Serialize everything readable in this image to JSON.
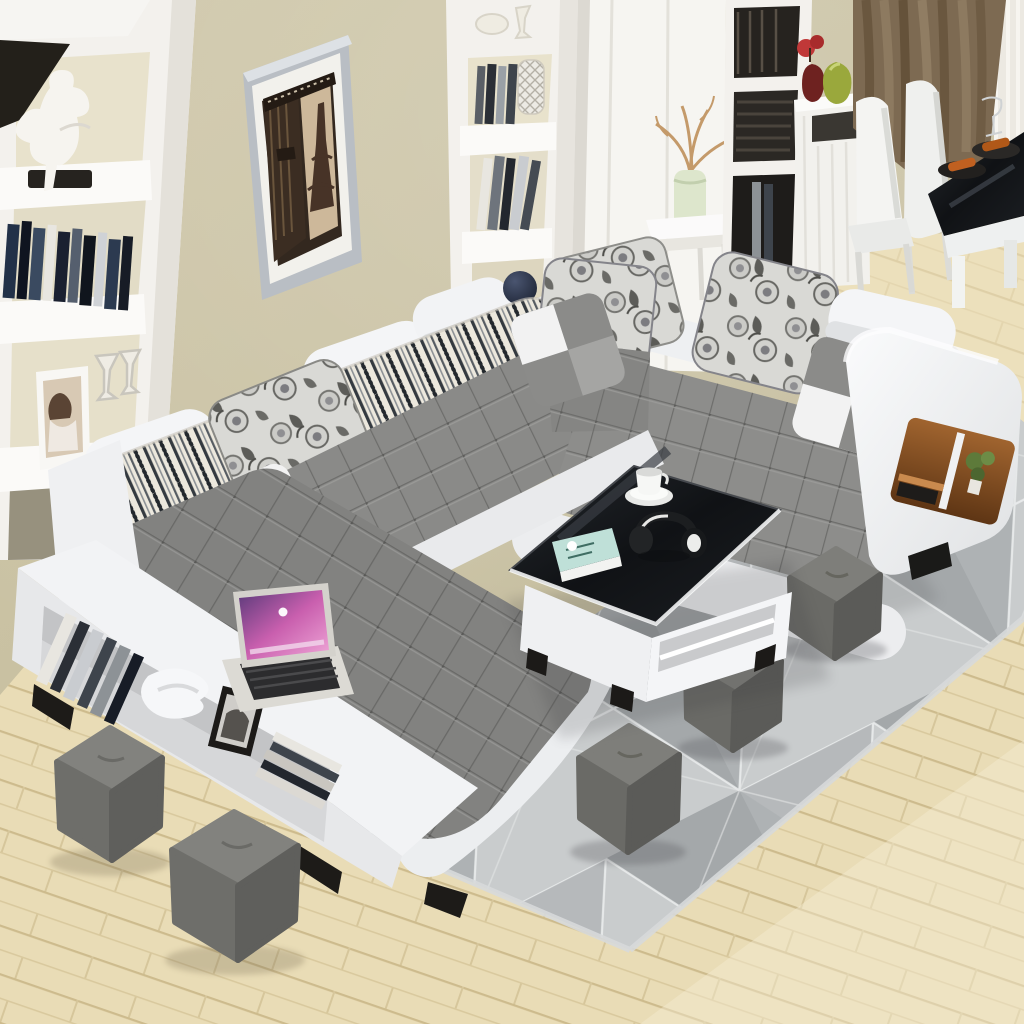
{
  "scene": {
    "type": "living-room-photograph",
    "description": "Modern living room, elevated view: white U-shaped sectional sofa with gray tufted cushions, patterned pillows, white storage console, coffee table with black glass top, gray cube ottomans, geometric gray rug on light wood floor, built-in white shelving, framed Eiffel Tower print, dining corner with curtains.",
    "objects": {
      "sofa": "u-shaped-sectional-white-gray",
      "pillows": {
        "floral": 4,
        "checkered": 3,
        "striped_bolsters": 3,
        "white_headrests": 4
      },
      "ottomans": 5,
      "coffee_table_items": [
        "white-cup-and-saucer",
        "black-headphones",
        "teal-book"
      ],
      "console_shelf_items": [
        "books",
        "white-sculpture",
        "black-photo-frame",
        "magazines"
      ],
      "laptop": "silver-laptop-pink-purple-wallpaper",
      "wall_art": "eiffel-tower-sepia-print-silver-frame",
      "left_bookcase_items": [
        "white-dancer-figurine",
        "books",
        "portrait-photo-frame",
        "glasses"
      ],
      "center_shelf_items": [
        "books",
        "lattice-vase",
        "dark-blue-sphere-vase"
      ],
      "right_storage": [
        "cube-shelf-with-books",
        "white-sideboard",
        "red-flower-vase",
        "green-vase"
      ],
      "side_table": "white-side-table-green-vase-dried-branches",
      "dining_corner": {
        "chairs": 2,
        "table": "black-glass-top",
        "tableware": [
          "wine-glass",
          "plates-with-food"
        ]
      },
      "curtains": [
        "brown-drape",
        "white-sheer"
      ],
      "sofa_arm_niche": [
        "wood-shelf",
        "small-plant",
        "books"
      ]
    }
  },
  "palette": {
    "wall_olive": "#c7bfa0",
    "wall_cream": "#e8e2cc",
    "shelf_white": "#f3f1ed",
    "sofa_white": "#f1f2f4",
    "sofa_gray": "#8a8a88",
    "tuft_seam": "#6e6e6c",
    "stripe_dark": "#343a40",
    "floral_base": "#d9d9d5",
    "rug_gray": "#b6b9bb",
    "rug_light": "#c9cccd",
    "rug_line_white": "#eef0f0",
    "floor_wood": "#e9dcb6",
    "floor_seam": "#cdbb8d",
    "table_black": "#17191c",
    "ottoman_gray": "#6f6f6d",
    "curtain_brown": "#7d6a52",
    "book_teal": "#bfe0d8",
    "laptop_screen": "#c95fae",
    "vase_green": "#9aa83c",
    "vase_red": "#a03030",
    "wood_niche": "#8a5428",
    "plant_green": "#5d7a3a"
  }
}
